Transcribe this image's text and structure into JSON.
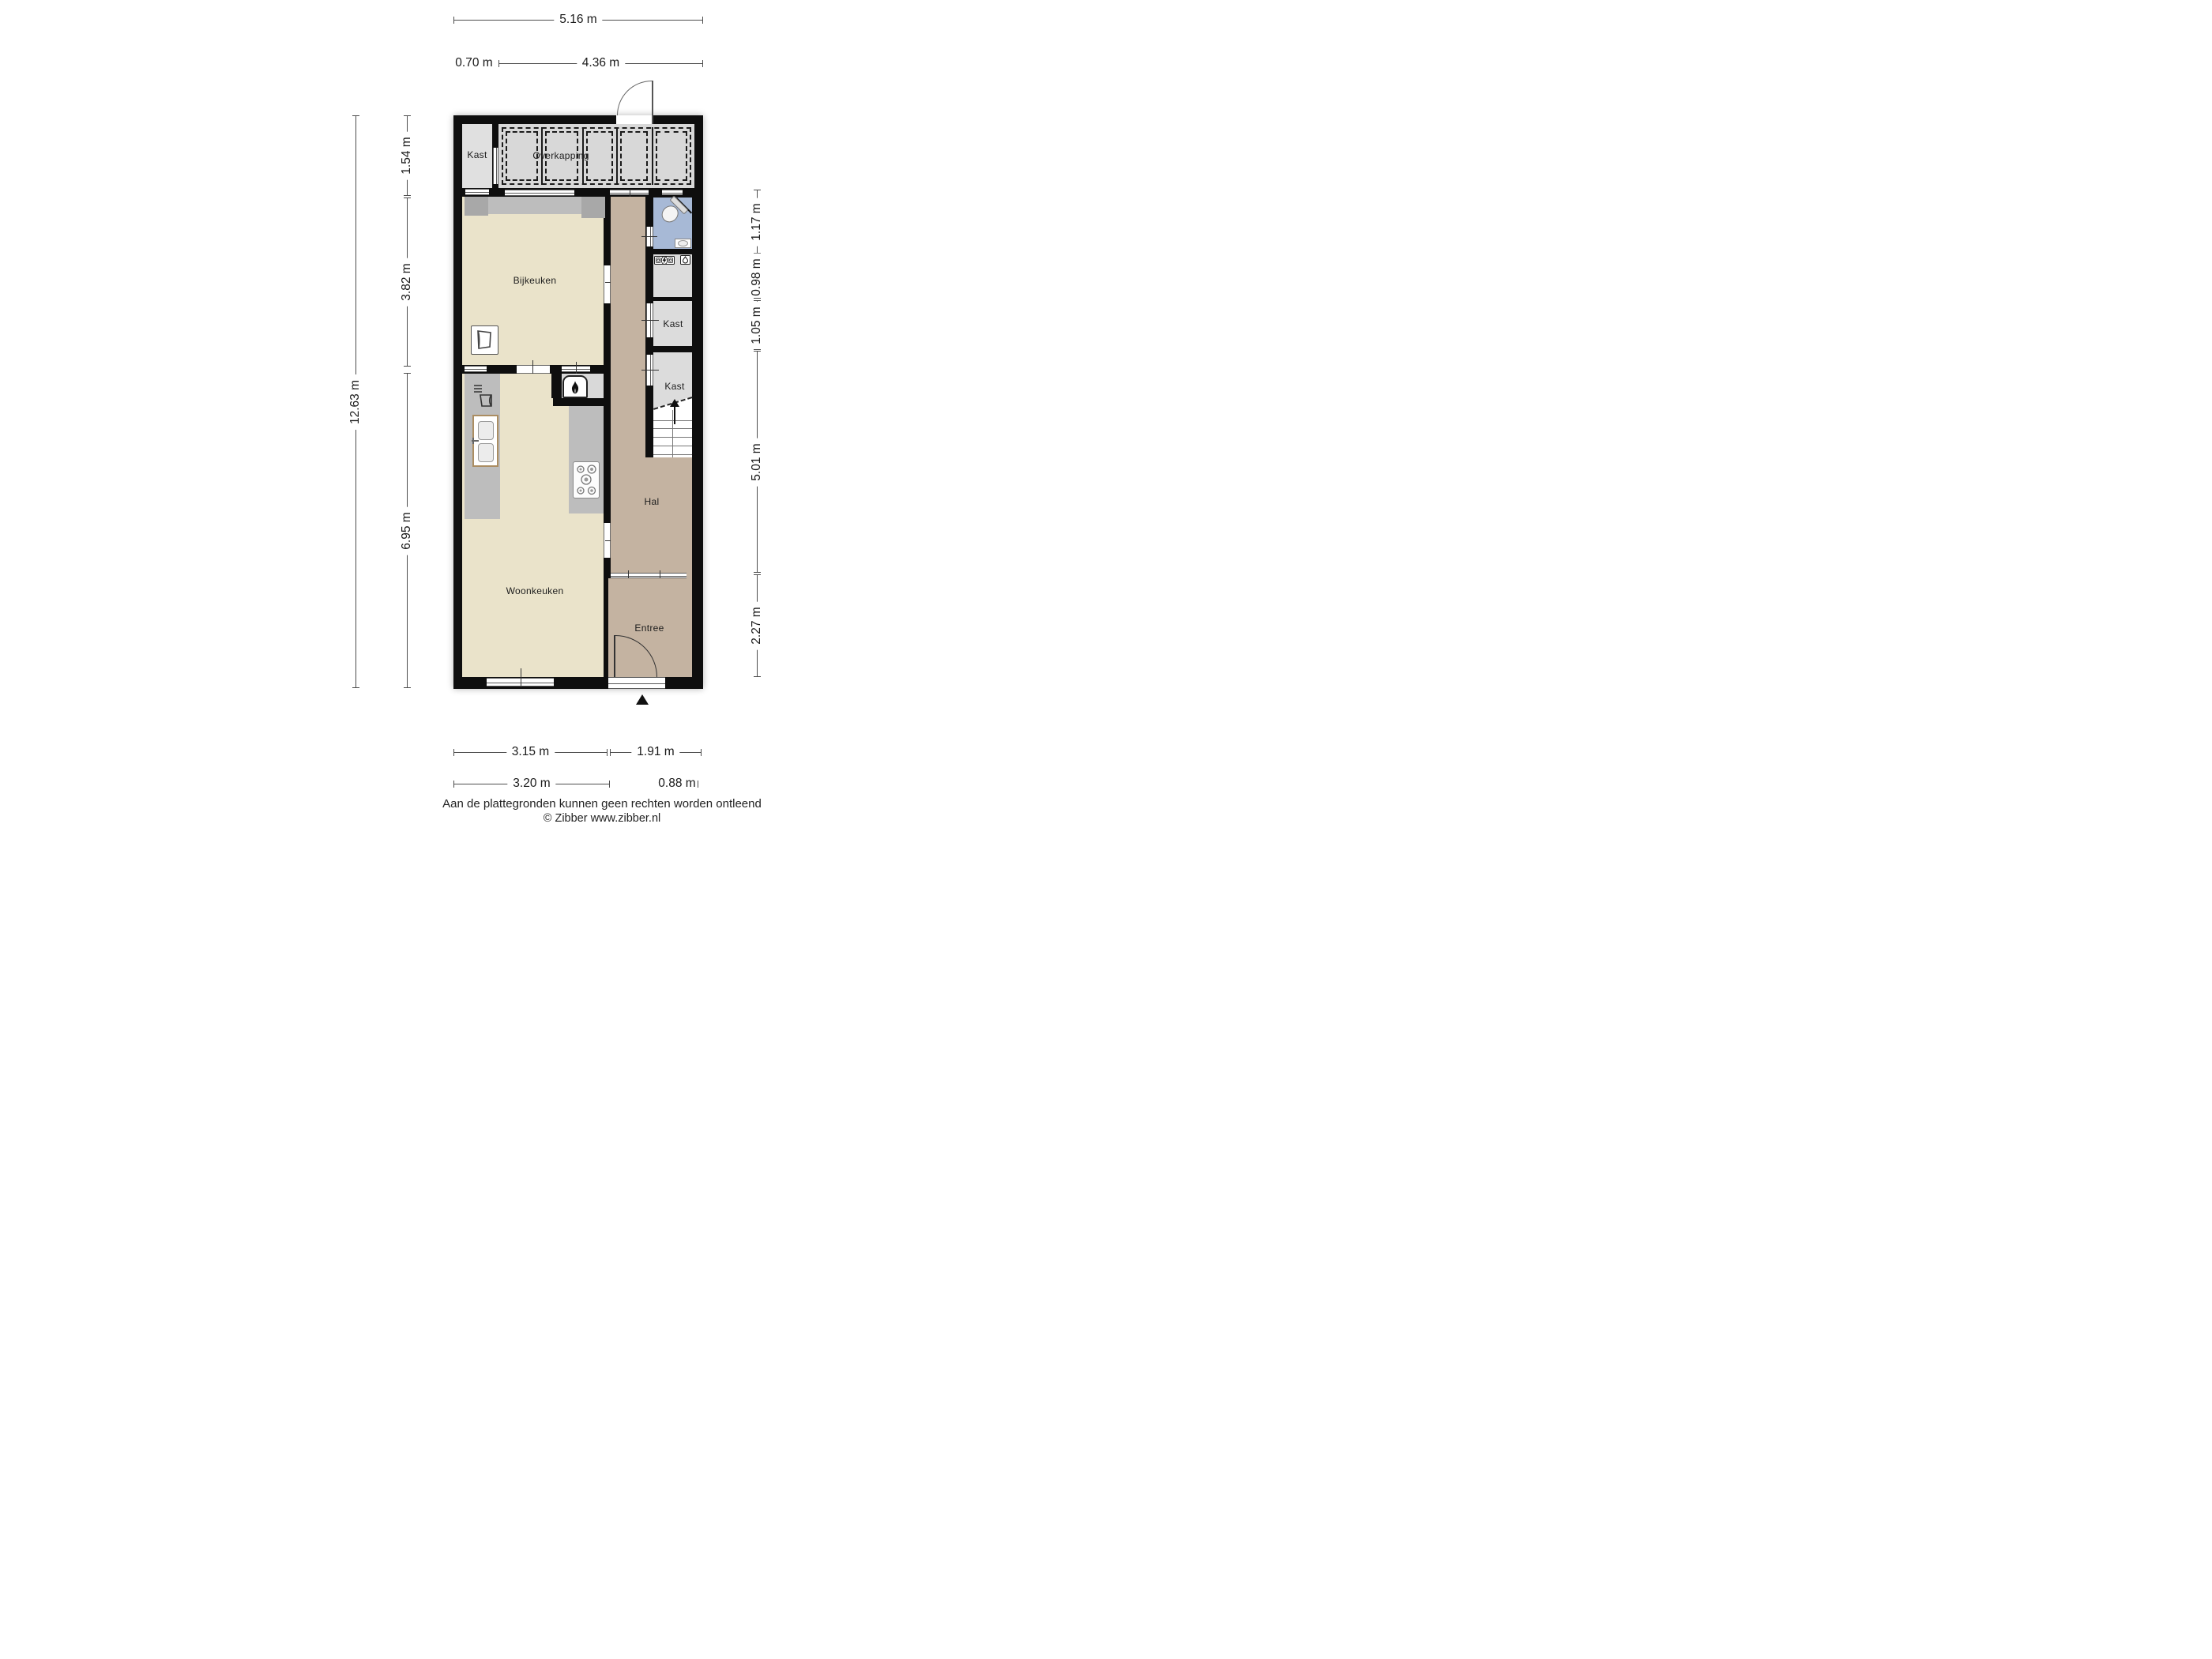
{
  "rooms": {
    "kast_top_left": {
      "label": "Kast"
    },
    "overkapping": {
      "label": "Overkapping"
    },
    "bijkeuken": {
      "label": "Bijkeuken"
    },
    "hal": {
      "label": "Hal"
    },
    "kast_upper": {
      "label": "Kast"
    },
    "kast_lower": {
      "label": "Kast"
    },
    "woonkeuken": {
      "label": "Woonkeuken"
    },
    "entree": {
      "label": "Entree"
    }
  },
  "dimensions": {
    "top_total": "5.16 m",
    "top_kast": "0.70 m",
    "top_overkapping": "4.36 m",
    "left_total": "12.63 m",
    "left_overkapping": "1.54 m",
    "left_bijkeuken": "3.82 m",
    "left_woonkeuken": "6.95 m",
    "right_toilet": "1.17 m",
    "right_meter": "0.98 m",
    "right_kast": "1.05 m",
    "right_hal": "5.01 m",
    "right_entree": "2.27 m",
    "bottom_woonkeuken": "3.15 m",
    "bottom_entree": "1.91 m",
    "bottom_woonkeuken_outer": "3.20 m",
    "bottom_door": "0.88 m"
  },
  "footer": {
    "line1": "Aan de plattegronden kunnen geen rechten worden ontleend",
    "line2": "© Zibber www.zibber.nl"
  },
  "colors": {
    "wall": "#0e0e0e",
    "floor_cream": "#eae3ca",
    "floor_tan": "#c4b3a1",
    "floor_gray": "#dcdcdc",
    "floor_blue": "#a7b9d6",
    "counter": "#bdbdbd",
    "counter_dark": "#a8a8a8",
    "overkapping_floor": "#d8d8d8"
  },
  "icons": [
    "washing-machine-icon",
    "dishwasher-icon",
    "kitchen-sink-icon",
    "gas-hob-icon",
    "fireplace-icon",
    "toilet-icon",
    "hand-basin-icon",
    "electric-meter-icon",
    "water-meter-icon",
    "stairs-up-arrow-icon",
    "entrance-marker-icon"
  ]
}
